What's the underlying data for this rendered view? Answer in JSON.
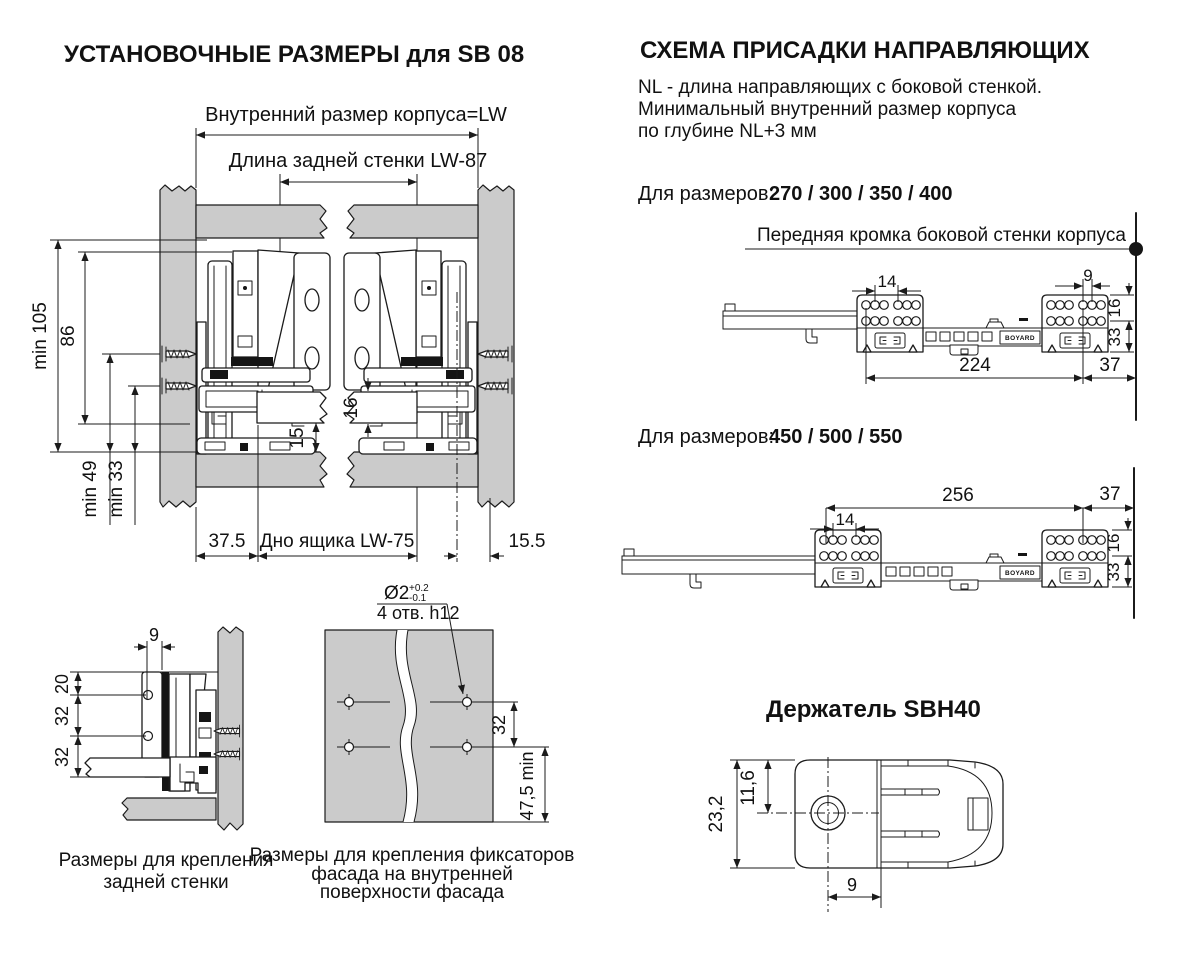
{
  "colors": {
    "panel_gray": "#cbcbcb",
    "line": "#1b1b1b"
  },
  "left": {
    "title": "УСТАНОВОЧНЫЕ РАЗМЕРЫ для SB 08",
    "main": {
      "lw_label": "Внутренний размер корпуса=LW",
      "back_wall_label": "Длина задней стенки  LW-87",
      "dim_min105": "min 105",
      "dim_86": "86",
      "dim_min49": "min 49",
      "dim_min33": "min 33",
      "dim_16": "16",
      "dim_15": "15",
      "dim_37_5": "37.5",
      "bottom_label": "Дно ящика  LW-75",
      "dim_15_5": "15.5"
    },
    "rear": {
      "dim_9": "9",
      "dim_20": "20",
      "dim_32a": "32",
      "dim_32b": "32",
      "caption1": "Размеры  для крепления",
      "caption2": "задней стенки"
    },
    "facade": {
      "diameter": "Ø2",
      "tol_plus": "+0.2",
      "tol_minus": "-0.1",
      "holes_note": "4 отв. h12",
      "dim_32": "32",
      "dim_47_5": "47,5 min",
      "caption1": "Размеры для крепления фиксаторов",
      "caption2": "фасада на внутренней",
      "caption3": "поверхности фасада"
    }
  },
  "right": {
    "title": "СХЕМА ПРИСАДКИ НАПРАВЛЯЮЩИХ",
    "note1": "NL - длина направляющих с боковой стенкой.",
    "note2": "Минимальный внутренний размер корпуса",
    "note3": "по глубине NL+3 мм",
    "d1": {
      "sizes_label": "Для размеров:",
      "sizes_values": "270 / 300 / 350 / 400",
      "front_edge_label": "Передняя кромка боковой стенки корпуса",
      "dim_14": "14",
      "dim_9": "9",
      "dim_16": "16",
      "dim_33": "33",
      "dim_224": "224",
      "dim_37": "37",
      "brand": "BOYARD"
    },
    "d2": {
      "sizes_label": "Для размеров:",
      "sizes_values": "450 / 500 / 550",
      "dim_14": "14",
      "dim_16": "16",
      "dim_33": "33",
      "dim_256": "256",
      "dim_37": "37",
      "brand": "BOYARD"
    },
    "holder": {
      "title": "Держатель SBH40",
      "dim_23_2": "23,2",
      "dim_11_6": "11,6",
      "dim_9": "9"
    }
  }
}
